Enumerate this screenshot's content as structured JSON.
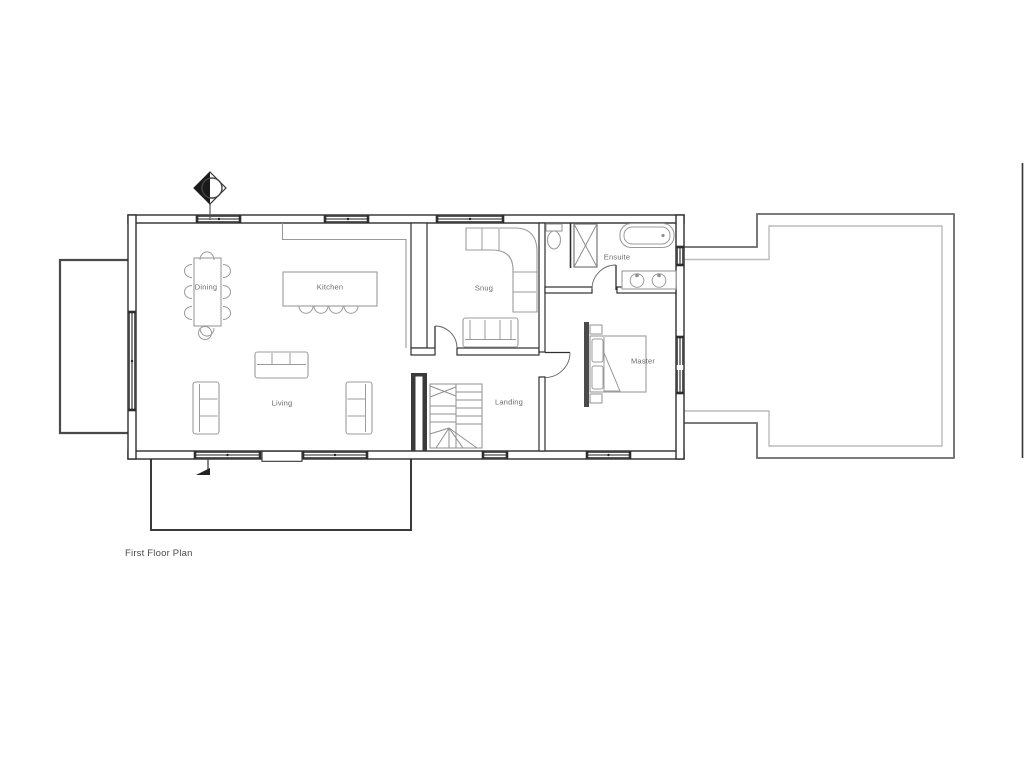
{
  "title": "First Floor Plan",
  "rooms": [
    {
      "id": "dining",
      "label": "Dining"
    },
    {
      "id": "kitchen",
      "label": "Kitchen"
    },
    {
      "id": "snug",
      "label": "Snug"
    },
    {
      "id": "ensuite",
      "label": "Ensuite"
    },
    {
      "id": "living",
      "label": "Living"
    },
    {
      "id": "landing",
      "label": "Landing"
    },
    {
      "id": "master",
      "label": "Master"
    }
  ],
  "symbols": {
    "north_arrow": "north-arrow",
    "downpipe": "rainwater-downpipe",
    "stairs": "winder-staircase"
  },
  "colors": {
    "wall": "#2e2e2e",
    "furniture": "#9b9b9b",
    "stairs": "#8f8f8f",
    "outline_dark": "#6a6a6a",
    "outline_light": "#bcbcbc",
    "balcony": "#4a4a4a",
    "terrace": "#3a3a3a",
    "label_text": "#6b6b6b",
    "title_text": "#4a4a4a",
    "background": "#ffffff"
  }
}
